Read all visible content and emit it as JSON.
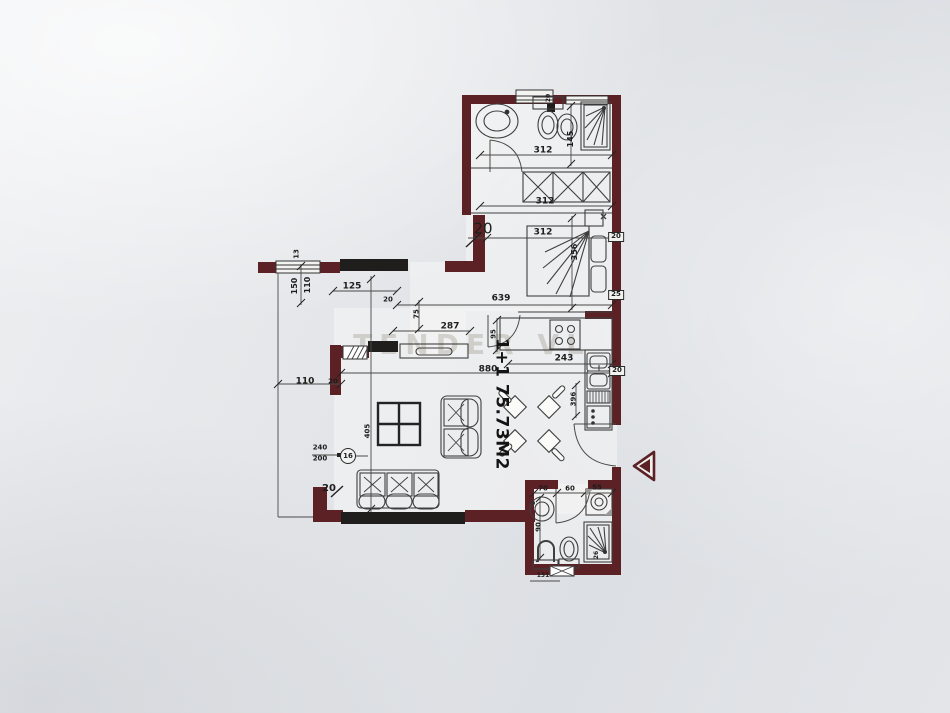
{
  "document": {
    "type": "apartment-floor-plan",
    "area_label": "1+1 75.73M2",
    "watermark": "TENDER VL"
  },
  "colors": {
    "wall": "#5b2125",
    "wall_black": "#201d1d",
    "furniture_line": "#3f3f3f",
    "dim_line": "#4a4a48",
    "dim_text": "#1d1d1d",
    "paper": "#e3e5e9"
  },
  "labels": [
    {
      "id": "dim-bath-width",
      "text": "312",
      "x": 543,
      "y": 151,
      "rot": 0,
      "fs": 9
    },
    {
      "id": "dim-hall-width",
      "text": "312",
      "x": 545,
      "y": 202,
      "rot": 0,
      "fs": 9
    },
    {
      "id": "dim-bedroom-width",
      "text": "312",
      "x": 543,
      "y": 233,
      "rot": 0,
      "fs": 9
    },
    {
      "id": "dim-bath-depth",
      "text": "145",
      "x": 571,
      "y": 139,
      "rot": -90,
      "fs": 8
    },
    {
      "id": "dim-window-20",
      "text": "20",
      "x": 549,
      "y": 98,
      "rot": -90,
      "fs": 6
    },
    {
      "id": "dim-bed-length",
      "text": "356",
      "x": 575,
      "y": 252,
      "rot": -90,
      "fs": 8
    },
    {
      "id": "label-wall-thickness-20",
      "text": "20",
      "x": 483,
      "y": 229,
      "rot": 0,
      "fs": 15,
      "w": "n"
    },
    {
      "id": "dim-total-639",
      "text": "639",
      "x": 501,
      "y": 299,
      "rot": 0,
      "fs": 9
    },
    {
      "id": "dim-hall-125",
      "text": "125",
      "x": 352,
      "y": 287,
      "rot": 0,
      "fs": 9
    },
    {
      "id": "dim-window-110",
      "text": "110",
      "x": 308,
      "y": 285,
      "rot": -90,
      "fs": 8
    },
    {
      "id": "dim-window-150",
      "text": "150",
      "x": 295,
      "y": 286,
      "rot": -90,
      "fs": 8
    },
    {
      "id": "dim-sill-13",
      "text": "13",
      "x": 297,
      "y": 254,
      "rot": -90,
      "fs": 7
    },
    {
      "id": "dim-opening-20",
      "text": "20",
      "x": 388,
      "y": 300,
      "rot": 0,
      "fs": 7
    },
    {
      "id": "dim-hall-75",
      "text": "75",
      "x": 417,
      "y": 314,
      "rot": -90,
      "fs": 7
    },
    {
      "id": "dim-hall-287",
      "text": "287",
      "x": 450,
      "y": 327,
      "rot": 0,
      "fs": 9
    },
    {
      "id": "dim-hall-95",
      "text": "95",
      "x": 494,
      "y": 334,
      "rot": -90,
      "fs": 7
    },
    {
      "id": "dim-living-880",
      "text": "880",
      "x": 488,
      "y": 370,
      "rot": 0,
      "fs": 9
    },
    {
      "id": "dim-kitchen-243",
      "text": "243",
      "x": 564,
      "y": 359,
      "rot": 0,
      "fs": 9
    },
    {
      "id": "dim-kitchen-396",
      "text": "396",
      "x": 574,
      "y": 399,
      "rot": -90,
      "fs": 7
    },
    {
      "id": "dim-terrace-110",
      "text": "110",
      "x": 305,
      "y": 382,
      "rot": 0,
      "fs": 9
    },
    {
      "id": "dim-wall-20",
      "text": "20",
      "x": 333,
      "y": 382,
      "rot": 0,
      "fs": 7
    },
    {
      "id": "dim-door-240",
      "text": "240",
      "x": 320,
      "y": 448,
      "rot": 0,
      "fs": 7
    },
    {
      "id": "dim-door-200",
      "text": "200",
      "x": 320,
      "y": 459,
      "rot": 0,
      "fs": 7
    },
    {
      "id": "marker-16",
      "text": "16",
      "x": 348,
      "y": 456,
      "rot": 0,
      "fs": 7,
      "kind": "circled"
    },
    {
      "id": "dim-corner-20",
      "text": "20",
      "x": 329,
      "y": 489,
      "rot": 0,
      "fs": 10
    },
    {
      "id": "dim-living-405",
      "text": "405",
      "x": 368,
      "y": 431,
      "rot": -90,
      "fs": 7
    },
    {
      "id": "dim-bath2-70",
      "text": "70",
      "x": 543,
      "y": 489,
      "rot": 0,
      "fs": 7
    },
    {
      "id": "dim-bath2-60",
      "text": "60",
      "x": 570,
      "y": 489,
      "rot": 0,
      "fs": 7
    },
    {
      "id": "dim-bath2-55",
      "text": "55",
      "x": 597,
      "y": 488,
      "rot": 0,
      "fs": 7
    },
    {
      "id": "dim-bath2-90",
      "text": "90",
      "x": 539,
      "y": 527,
      "rot": -90,
      "fs": 7
    },
    {
      "id": "dim-bath2-26",
      "text": "26",
      "x": 597,
      "y": 555,
      "rot": -90,
      "fs": 6
    },
    {
      "id": "dim-bath2-131",
      "text": "131",
      "x": 543,
      "y": 576,
      "rot": 0,
      "fs": 6
    },
    {
      "id": "marker-wall-20-top",
      "text": "20",
      "x": 616,
      "y": 237,
      "rot": 0,
      "fs": 7,
      "kind": "boxed"
    },
    {
      "id": "marker-wall-25",
      "text": "25",
      "x": 616,
      "y": 295,
      "rot": 0,
      "fs": 7,
      "kind": "boxed"
    },
    {
      "id": "marker-wall-20-mid",
      "text": "20",
      "x": 617,
      "y": 371,
      "rot": 0,
      "fs": 7,
      "kind": "boxed"
    },
    {
      "id": "area-label",
      "text": "1+1 75.73M2",
      "x": 501,
      "y": 404,
      "rot": 90,
      "fs": 17,
      "kind": "area"
    }
  ]
}
